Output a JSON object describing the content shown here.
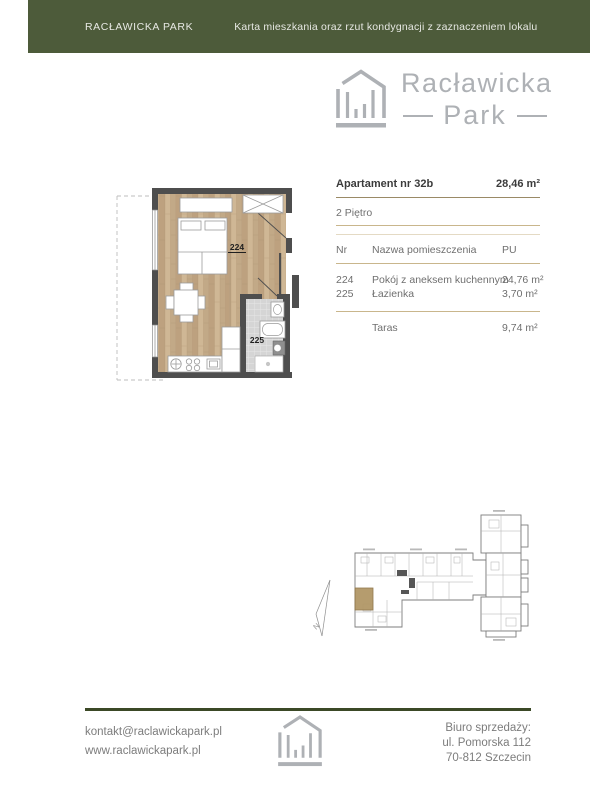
{
  "header": {
    "brand": "RACŁAWICKA PARK",
    "title": "Karta mieszkania oraz rzut kondygnacji z zaznaczeniem lokalu"
  },
  "logo": {
    "line1": "Racławicka",
    "line2": "Park"
  },
  "apartment": {
    "title": "Apartament nr 32b",
    "total_area": "28,46 m²",
    "floor": "2 Piętro",
    "columns": {
      "nr": "Nr",
      "name": "Nazwa pomieszczenia",
      "area": "PU"
    },
    "rooms": [
      {
        "nr": "224",
        "name": "Pokój z aneksem kuchennym",
        "area": "24,76 m²"
      },
      {
        "nr": "225",
        "name": "Łazienka",
        "area": "3,70 m²"
      }
    ],
    "terrace": {
      "name": "Taras",
      "area": "9,74 m²"
    }
  },
  "plan": {
    "room1_label": "224",
    "room2_label": "225"
  },
  "overview": {
    "north_label": "N"
  },
  "footer": {
    "email": "kontakt@raclawickapark.pl",
    "website": "www.raclawickapark.pl",
    "office": "Biuro sprzedaży:",
    "address1": "ul. Pomorska 112",
    "address2": "70-812 Szczecin"
  },
  "colors": {
    "green": "#4d5b3a",
    "green_dark": "#3b4926",
    "logo_gray": "#aeb1b5",
    "line_dark": "#9a8a66",
    "line_tan": "#c9b68c",
    "line_faint": "#e4dac4",
    "wood": "#c7ae8d",
    "unit_highlight": "#b29767"
  }
}
